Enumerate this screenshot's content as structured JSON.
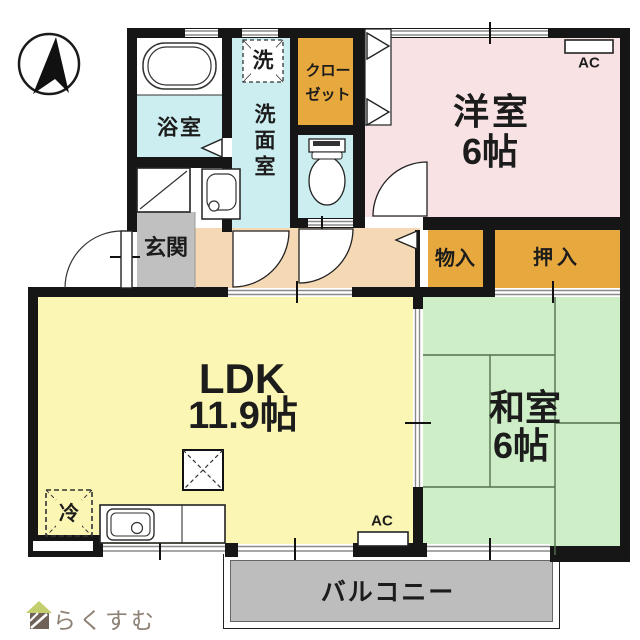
{
  "compass": {
    "description": "north-arrow"
  },
  "rooms": {
    "bathroom": {
      "label": "浴室"
    },
    "laundry": {
      "label": "洗"
    },
    "washroom": {
      "label": "洗面室"
    },
    "closet": {
      "line1": "クロー",
      "line2": "ゼット"
    },
    "entrance": {
      "label": "玄関"
    },
    "western_room": {
      "name": "洋室",
      "size": "6帖"
    },
    "storage_small": {
      "label": "物入"
    },
    "storage_futon": {
      "label": "押入"
    },
    "ldk": {
      "name": "LDK",
      "size": "11.9帖"
    },
    "japanese_room": {
      "name": "和室",
      "size": "6帖"
    },
    "balcony": {
      "label": "バルコニー"
    }
  },
  "appliances": {
    "refrigerator": "冷",
    "air_conditioner": "AC"
  },
  "logo": {
    "text": "らくすむ"
  },
  "colors": {
    "wet_area_cyan": "#cdeef0",
    "western_room_pink": "#f8e2e4",
    "storage_orange": "#e7a83d",
    "ldk_yellow": "#fbf6b3",
    "japanese_room_green": "#cdeec6",
    "hallway_peach": "#f5d8b4",
    "entrance_gray": "#c0c0c0",
    "balcony_gray": "#bdbdbd",
    "wall_black": "#161616",
    "logo_brown": "#8e8175"
  }
}
